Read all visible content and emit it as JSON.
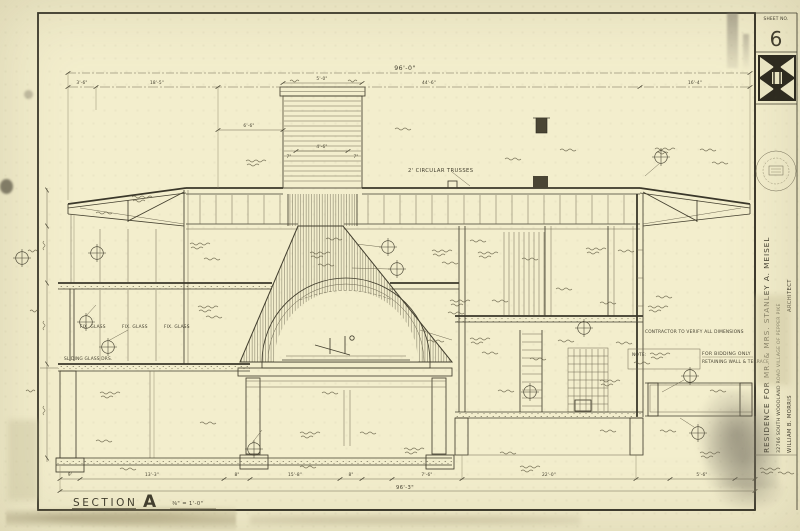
{
  "sheet": {
    "sheet_no_label": "SHEET NO.",
    "sheet_no": "6",
    "section_label": "SECTION",
    "section_letter": "A",
    "section_scale": "⅜\" = 1'-0\""
  },
  "title_block": {
    "project": "RESIDENCE FOR MR. & MRS. STANLEY A. MEISEL",
    "address": "32766 SOUTH WOODLAND ROAD   VILLAGE OF PEPPER PIKE",
    "architect_name": "WILLIAM B. MORRIS",
    "architect_title": "ARCHITECT"
  },
  "dims": {
    "top_overall": "96'-0\"",
    "top_seg_1": "3'-6\"",
    "top_seg_2": "18'-5\"",
    "top_seg_3": "44'-6\"",
    "top_seg_4": "16'-4\"",
    "chimney_offset": "6'-6\"",
    "chimney_top": "5'-0\"",
    "chimney_width": "4'-6\"",
    "chimney_side_l": "7\"",
    "chimney_side_r": "7\"",
    "bot_1": "9'",
    "bot_2": "13'-3\"",
    "bot_3": "8\"",
    "bot_4": "15'-8\"",
    "bot_5": "8\"",
    "bot_6": "7'-6\"",
    "bot_7": "22'-0\"",
    "bot_8": "5'-6\"",
    "bot_overall": "96'-3\""
  },
  "annotations": {
    "trusses": "2' CIRCULAR TRUSSES",
    "verify": "CONTRACTOR TO VERIFY ALL DIMENSIONS",
    "fix_glass_1": "FIX. GLASS",
    "fix_glass_2": "FIX. GLASS",
    "fix_glass_3": "FIX. GLASS",
    "sliding_doors": "SLIDING GLASS DRS.",
    "note_label": "NOTE:",
    "bidding": "FOR BIDDING ONLY",
    "retaining": "RETAINING WALL & TERRACE"
  },
  "colors": {
    "paper": "#f3eecd",
    "ink": "#423e2e"
  }
}
